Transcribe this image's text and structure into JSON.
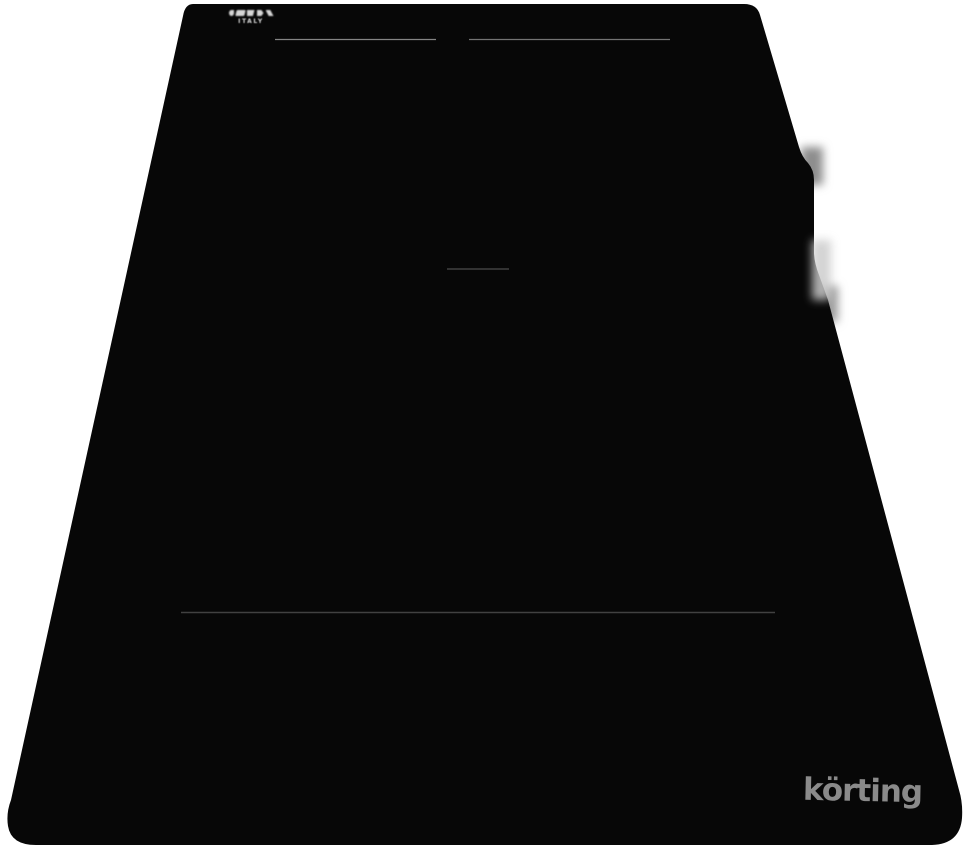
{
  "product": {
    "brand": "körting",
    "badge": {
      "country_label": "ITALY"
    }
  },
  "colors": {
    "background": "#ffffff",
    "glass_black": "#070707",
    "brand_gray": "#8a8a8a",
    "badge_text": "#d9d9d9",
    "zone_line_light": "#9a9a9a",
    "zone_line_light2": "#8f8f8f",
    "zone_line_mid": "#555555",
    "zone_line_dark": "#454545"
  }
}
